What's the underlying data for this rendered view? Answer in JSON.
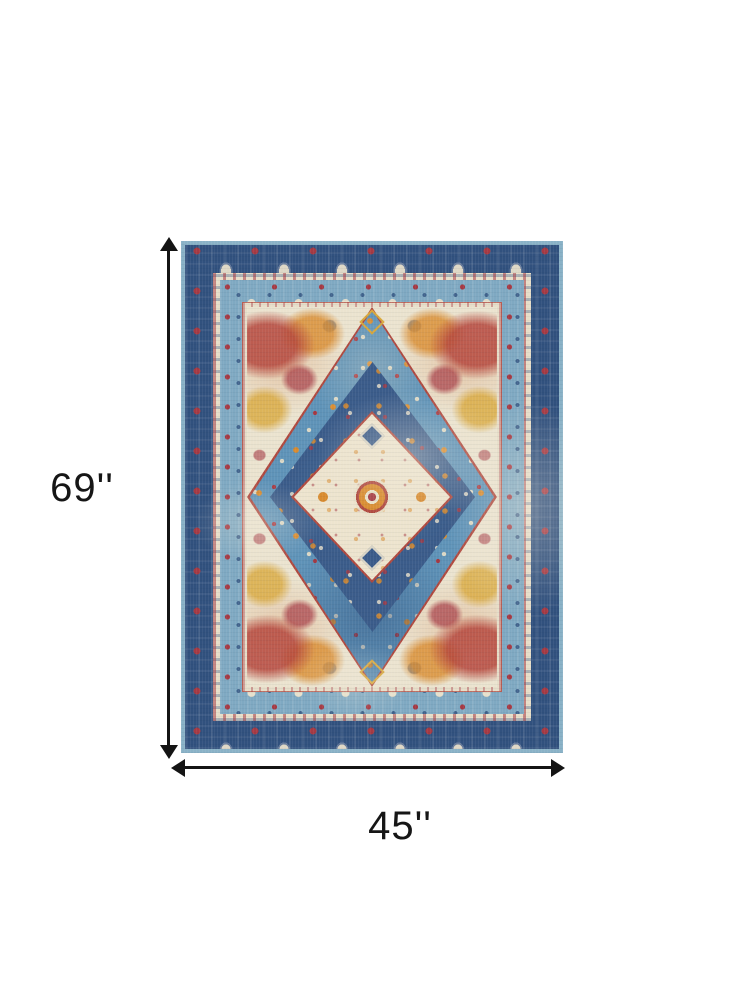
{
  "figure": {
    "type": "product-dimension-diagram",
    "subject": "distressed oriental medallion area rug in blue, ivory, red and orange",
    "height_label": "69''",
    "width_label": "45''",
    "height_inches": 69,
    "width_inches": 45,
    "background": "#ffffff",
    "arrow_color": "#141414"
  },
  "colors": {
    "edge_blue": "#8ab2c7",
    "border_navy": "#31517e",
    "border_blue": "#7fa9c2",
    "guard_cream": "#e7dec9",
    "field_cream": "#ebe3cf",
    "diamond_blue": "#5f93b8",
    "diamond_navy": "#3b5c8a",
    "medallion_cream": "#ede4ce",
    "accent_red": "#b0493f",
    "accent_maroon": "#a53a44",
    "accent_orange": "#d98b2e",
    "accent_gold": "#d9a83c"
  }
}
